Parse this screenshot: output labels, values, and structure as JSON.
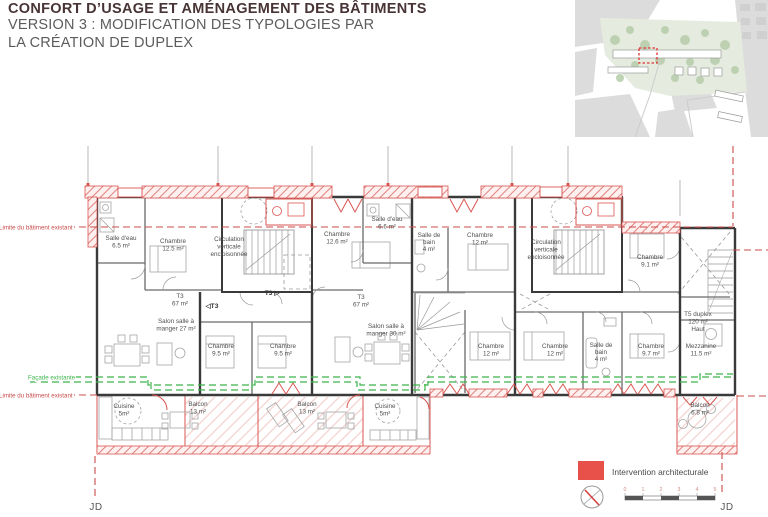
{
  "header": {
    "title": "CONFORT D’USAGE ET AMÉNAGEMENT DES BÂTIMENTS",
    "subtitle_line1": "VERSION 3 : MODIFICATION DES TYPOLOGIES PAR",
    "subtitle_line2": "LA CRÉATION DE DUPLEX"
  },
  "annotations": {
    "limit_top": "Limite du bâtiment existant",
    "facade": "Façade existante",
    "limit_bottom": "Limite du bâtiment existant",
    "author_initials": "JD"
  },
  "legend": {
    "label": "Intervention architecturale",
    "ticks": [
      "0",
      "1",
      "2",
      "3",
      "4",
      "5"
    ]
  },
  "colors": {
    "intervention": "#e8504a",
    "limit_line": "#c94b4b",
    "facade_line": "#3cb54a",
    "title_text": "#483436"
  },
  "plan": {
    "rooms": [
      {
        "id": "salle-deau-a",
        "lines": [
          "Salle d'eau",
          "6.5 m²"
        ]
      },
      {
        "id": "chambre-12-5",
        "lines": [
          "Chambre",
          "12.5 m²"
        ]
      },
      {
        "id": "circulation-a",
        "lines": [
          "Circulation",
          "verticale",
          "encloisonnée"
        ]
      },
      {
        "id": "chambre-12-6",
        "lines": [
          "Chambre",
          "12.6 m²"
        ]
      },
      {
        "id": "salle-deau-b",
        "lines": [
          "Salle d'eau",
          "6.6 m²"
        ]
      },
      {
        "id": "sdb-a",
        "lines": [
          "Salle de",
          "bain",
          "4 m²"
        ]
      },
      {
        "id": "chambre-12-a",
        "lines": [
          "Chambre",
          "12 m²"
        ]
      },
      {
        "id": "circulation-b",
        "lines": [
          "Circulation",
          "verticale",
          "encloisonnée"
        ]
      },
      {
        "id": "chambre-9-1",
        "lines": [
          "Chambre",
          "9.1 m²"
        ]
      },
      {
        "id": "t3-a",
        "lines": [
          "T3",
          "67 m²"
        ]
      },
      {
        "id": "t3-entry-left",
        "lines": [
          "◁T3"
        ]
      },
      {
        "id": "t3-entry-right",
        "lines": [
          "T3 ▷"
        ]
      },
      {
        "id": "t3-b",
        "lines": [
          "T3",
          "67 m²"
        ]
      },
      {
        "id": "salon-a",
        "lines": [
          "Salon salle à",
          "manger 27 m²"
        ]
      },
      {
        "id": "salon-b",
        "lines": [
          "Salon salle à",
          "manger 30 m²"
        ]
      },
      {
        "id": "chambre-9-5-a",
        "lines": [
          "Chambre",
          "9.5 m²"
        ]
      },
      {
        "id": "chambre-9-5-b",
        "lines": [
          "Chambre",
          "9.5 m²"
        ]
      },
      {
        "id": "chambre-12-b",
        "lines": [
          "Chambre",
          "12 m²"
        ]
      },
      {
        "id": "chambre-12-c",
        "lines": [
          "Chambre",
          "12 m²"
        ]
      },
      {
        "id": "sdb-b",
        "lines": [
          "Salle de",
          "bain",
          "4 m²"
        ]
      },
      {
        "id": "chambre-9-7",
        "lines": [
          "Chambre",
          "9.7 m²"
        ]
      },
      {
        "id": "t5-duplex",
        "lines": [
          "T5 duplex",
          "120 m²",
          "Haut"
        ]
      },
      {
        "id": "mezzanine",
        "lines": [
          "Mezzanine",
          "11.5 m²"
        ]
      },
      {
        "id": "cuisine-a",
        "lines": [
          "Cuisine",
          "5m²"
        ]
      },
      {
        "id": "balcon-a",
        "lines": [
          "Balcon",
          "13 m²"
        ]
      },
      {
        "id": "balcon-b",
        "lines": [
          "Balcon",
          "13 m²"
        ]
      },
      {
        "id": "cuisine-b",
        "lines": [
          "Cuisine",
          "5m²"
        ]
      },
      {
        "id": "balcon-c",
        "lines": [
          "Balcon",
          "6.8 m²"
        ]
      }
    ]
  }
}
